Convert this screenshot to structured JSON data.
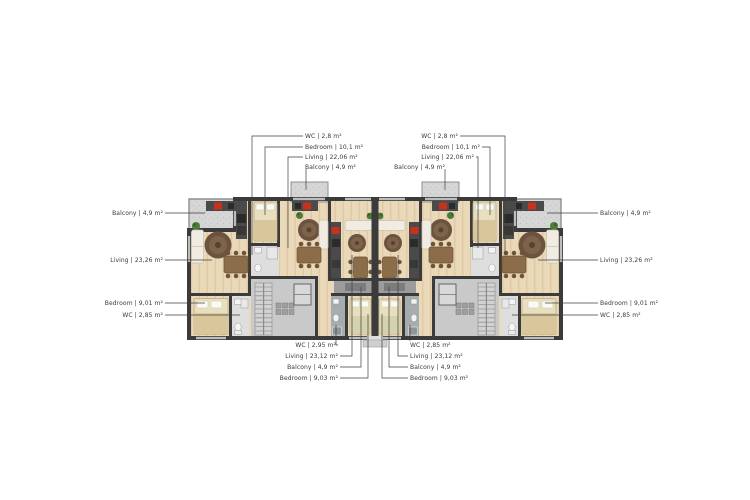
{
  "figure_type": "apartment-building-floor-plan",
  "labels": {
    "top_left": {
      "wc": "WC | 2,8 m²",
      "bedroom": "Bedroom | 10,1 m²",
      "living": "Living | 22,06 m²",
      "balcony": "Balcony | 4,9 m²"
    },
    "top_right": {
      "wc": "WC | 2,8 m²",
      "bedroom": "Bedroom | 10,1 m²",
      "living": "Living | 22,06 m²",
      "balcony": "Balcony | 4,9 m²"
    },
    "left": {
      "balcony": "Balcony | 4,9 m²",
      "living": "Living | 23,26 m²",
      "bedroom": "Bedroom | 9,01 m²",
      "wc": "WC | 2,85 m²"
    },
    "right": {
      "balcony": "Balcony | 4,9 m²",
      "living": "Living | 23,26 m²",
      "bedroom": "Bedroom | 9,01 m²",
      "wc": "WC | 2,85 m²"
    },
    "bottom_left": {
      "wc": "WC | 2,95 m²",
      "living": "Living | 23,12 m²",
      "balcony": "Balcony | 4,9 m²",
      "bedroom": "Bedroom | 9,03 m²"
    },
    "bottom_right": {
      "wc": "WC | 2,85 m²",
      "living": "Living | 23,12 m²",
      "balcony": "Balcony | 4,9 m²",
      "bedroom": "Bedroom | 9,03 m²"
    }
  },
  "palette": {
    "wall": "#3b3b3b",
    "wood_floor": "#ead9b8",
    "balcony_gray": "#d6d6d6",
    "core_gray": "#c9c9c9",
    "loggia_gray": "#9c9c9c",
    "rug_brown": "#6b5340",
    "stove_red": "#c7321f",
    "plant_green": "#4c7a38",
    "bed_cream": "#e8dec0",
    "blanket_tan": "#d9c79b",
    "label_text": "#3a3a3a"
  }
}
